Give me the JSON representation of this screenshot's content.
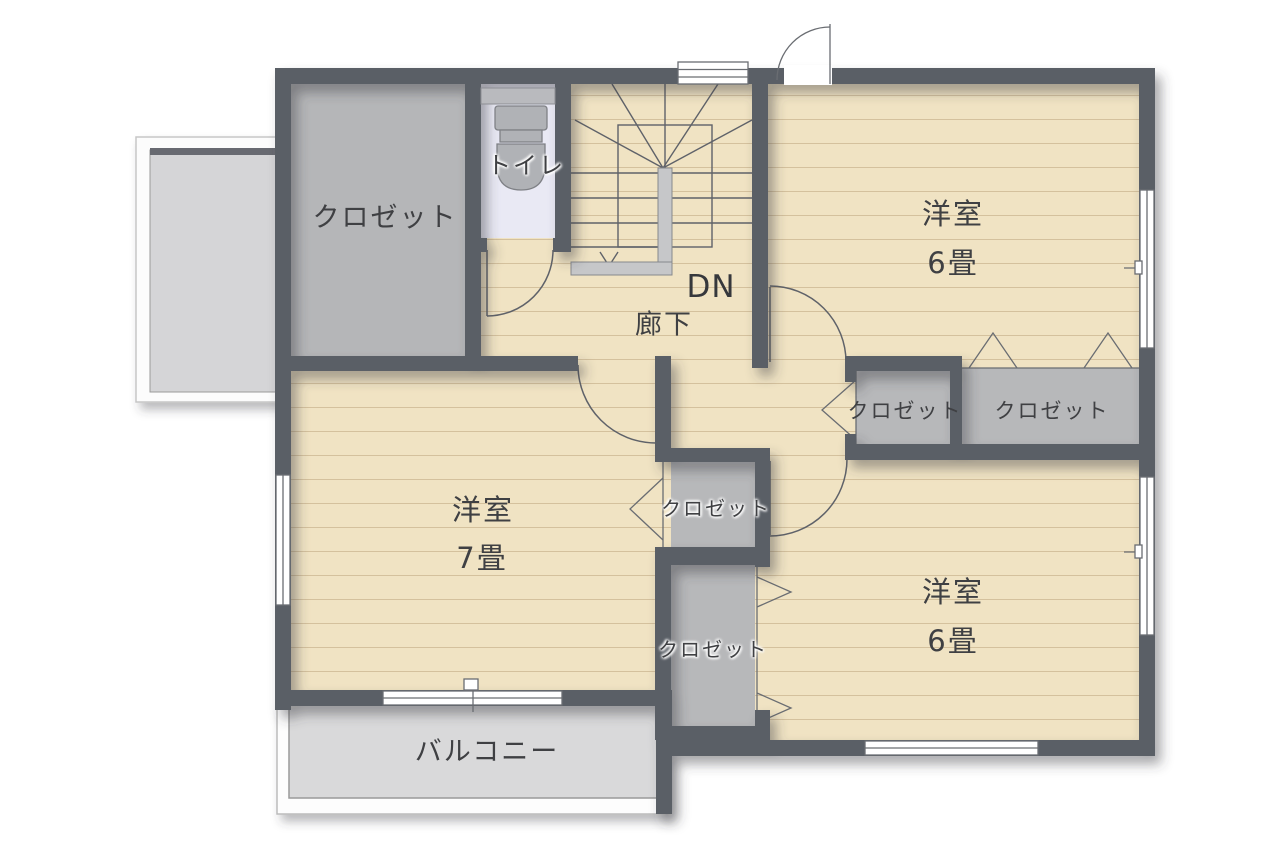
{
  "floorplan": {
    "type": "residential-floor-plan-2F",
    "colors": {
      "wall": "#5a5e66",
      "wood_floor": "#f0e3c3",
      "wood_line": "#9b7d50",
      "closet_floor": "#b6b7b9",
      "toilet_floor": "#e9e9f4",
      "balcony_floor": "#d9d9da",
      "outline": "#5f6269",
      "text": "#3f4043"
    },
    "rooms": {
      "closet_top_left": {
        "label": "クロゼット"
      },
      "toilet": {
        "label": "トイレ"
      },
      "stair_note": {
        "label": "DN"
      },
      "hallway": {
        "label": "廊下"
      },
      "bedroom_top_right": {
        "label": "洋室",
        "area": "6畳"
      },
      "closet_hall_left": {
        "label": "クロゼット"
      },
      "closet_hall_right": {
        "label": "クロゼット"
      },
      "bedroom_left": {
        "label": "洋室",
        "area": "7畳"
      },
      "closet_center_upper": {
        "label": "クロゼット"
      },
      "closet_center_lower": {
        "label": "クロゼット"
      },
      "bedroom_bottom_right": {
        "label": "洋室",
        "area": "6畳"
      },
      "balcony": {
        "label": "バルコニー"
      }
    }
  }
}
